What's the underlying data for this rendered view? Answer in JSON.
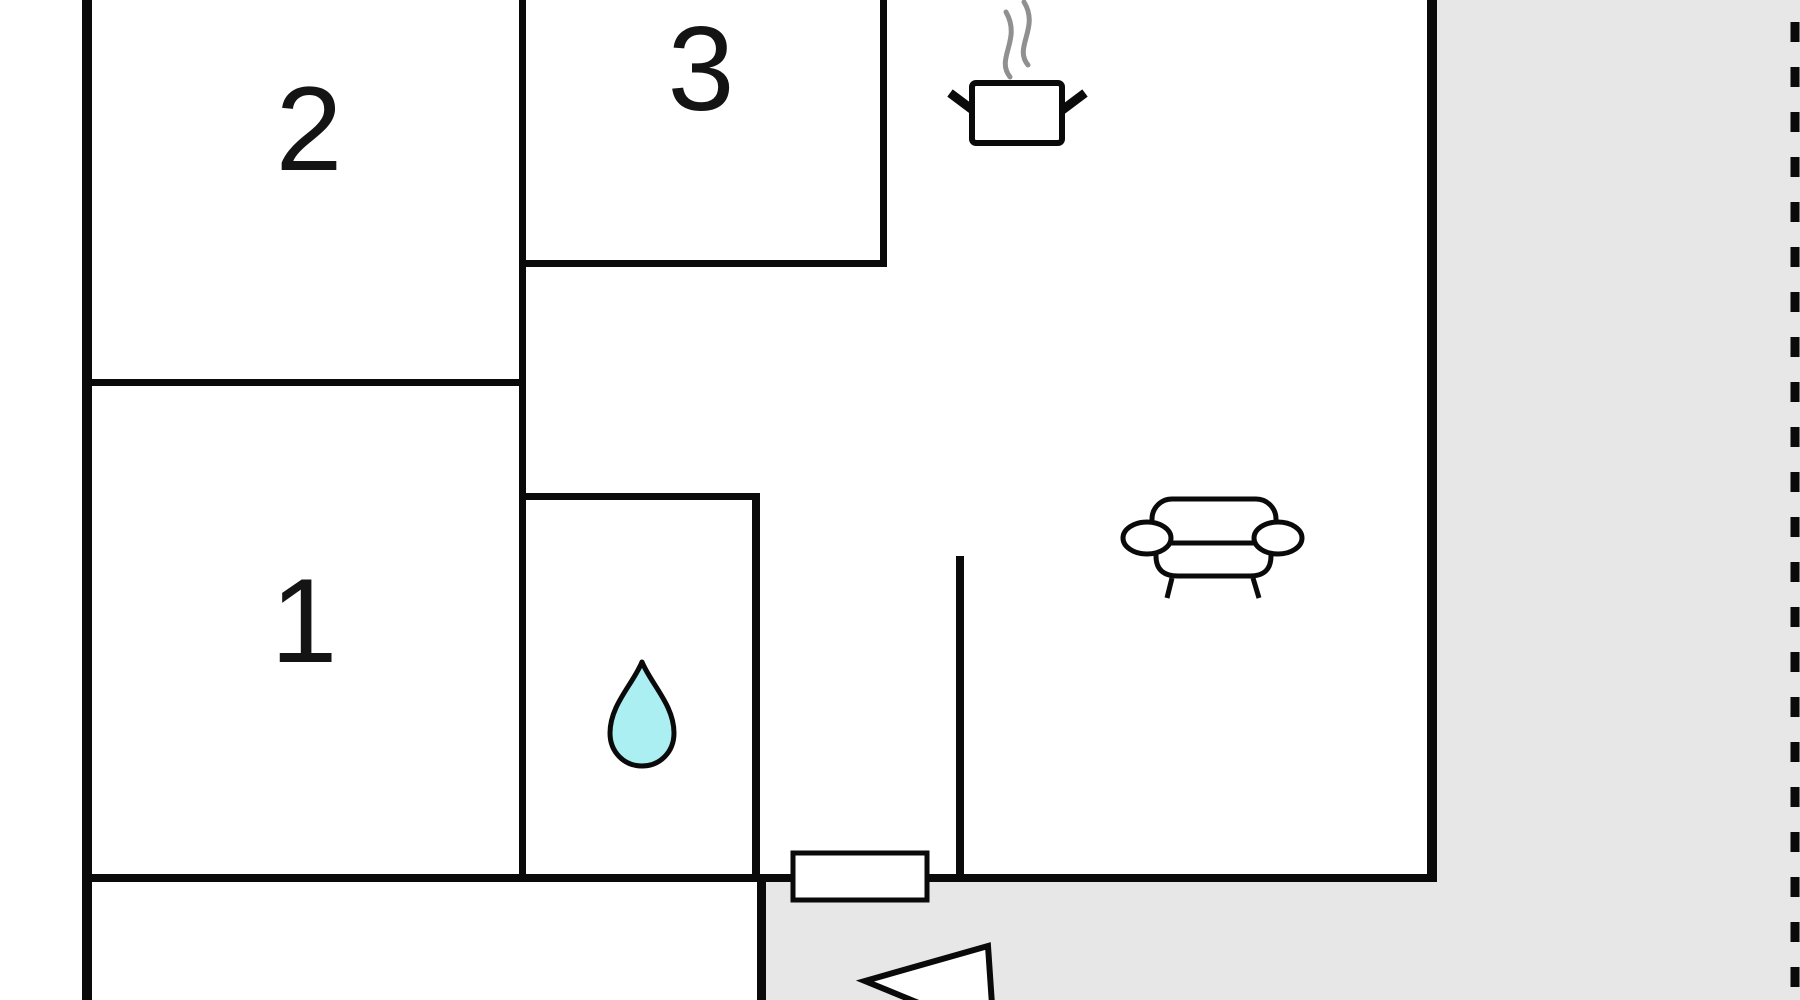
{
  "plan_type": "apartment-floor-plan",
  "rooms": [
    {
      "number": "1"
    },
    {
      "number": "2"
    },
    {
      "number": "3"
    }
  ],
  "icons": {
    "kitchen": "cooking-pot-with-steam",
    "living_room": "sofa",
    "bathroom": "water-drop",
    "entrance": "left-pointing-arrow"
  },
  "colors": {
    "wall": "#0a0a0a",
    "interior": "#ffffff",
    "exterior": "#e7e7e7",
    "water_drop_fill": "#abeff2",
    "steam": "#909090",
    "label": "#141414"
  }
}
